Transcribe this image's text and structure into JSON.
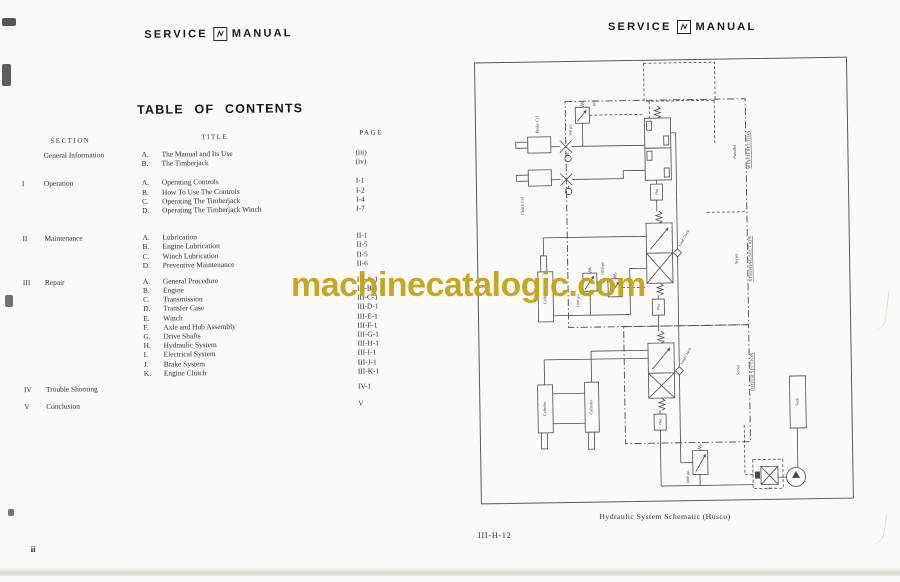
{
  "header": {
    "service": "SERVICE",
    "manual": "MANUAL"
  },
  "watermark": {
    "text": "machinecatalogic.com",
    "color": "#c2a016"
  },
  "left_page": {
    "title": "TABLE OF CONTENTS",
    "columns": {
      "section": "SECTION",
      "title": "TITLE",
      "page": "PAGE"
    },
    "groups": [
      {
        "numeral": "",
        "name": "General Information",
        "items": [
          {
            "letter": "A.",
            "title": "The Manual and Its Use",
            "page": "(iii)"
          },
          {
            "letter": "B.",
            "title": "The Timberjack",
            "page": "(iv)"
          }
        ]
      },
      {
        "numeral": "I",
        "name": "Operation",
        "items": [
          {
            "letter": "A.",
            "title": "Operating Controls",
            "page": "I-1"
          },
          {
            "letter": "B.",
            "title": "How To Use The Controls",
            "page": "I-2"
          },
          {
            "letter": "C.",
            "title": "Operating The Timberjack",
            "page": "I-4"
          },
          {
            "letter": "D.",
            "title": "Operating The Timberjack Winch",
            "page": "I-7"
          }
        ]
      },
      {
        "numeral": "II",
        "name": "Maintenance",
        "items": [
          {
            "letter": "A.",
            "title": "Lubrication",
            "page": "II-1"
          },
          {
            "letter": "B.",
            "title": "Engine Lubrication",
            "page": "II-5"
          },
          {
            "letter": "C.",
            "title": "Winch Lubrication",
            "page": "II-5"
          },
          {
            "letter": "D.",
            "title": "Preventive Maintenance",
            "page": "II-6"
          }
        ]
      },
      {
        "numeral": "III",
        "name": "Repair",
        "items": [
          {
            "letter": "A.",
            "title": "General Procedure",
            "page": "III-A-1"
          },
          {
            "letter": "B.",
            "title": "Engine",
            "page": "III-B-1"
          },
          {
            "letter": "C.",
            "title": "Transmission",
            "page": "III-C-1"
          },
          {
            "letter": "D.",
            "title": "Transfer Case",
            "page": "III-D-1"
          },
          {
            "letter": "E.",
            "title": "Winch",
            "page": "III-E-1"
          },
          {
            "letter": "F.",
            "title": "Axle and Hub Assembly",
            "page": "III-F-1"
          },
          {
            "letter": "G.",
            "title": "Drive Shafts",
            "page": "III-G-1"
          },
          {
            "letter": "H.",
            "title": "Hydraulic System",
            "page": "III-H-1"
          },
          {
            "letter": "I.",
            "title": "Electrical System",
            "page": "III-I-1"
          },
          {
            "letter": "J.",
            "title": "Brake System",
            "page": "III-J-1"
          },
          {
            "letter": "K.",
            "title": "Engine Clutch",
            "page": "III-K-1"
          }
        ]
      },
      {
        "numeral": "IV",
        "name": "Trouble Shooting",
        "items": [
          {
            "letter": "",
            "title": "",
            "page": "IV-1"
          }
        ]
      },
      {
        "numeral": "V",
        "name": "Conclusion",
        "items": [
          {
            "letter": "",
            "title": "",
            "page": "V"
          }
        ]
      }
    ],
    "page_number": "ii"
  },
  "right_page": {
    "caption": "Hydraulic System Schematic (Husco)",
    "page_ref": "III-H-12",
    "schematic": {
      "sections": [
        {
          "mode": "Parallel",
          "name": "WINCH SECTION"
        },
        {
          "mode": "Series",
          "name": "STEERING SECTION"
        },
        {
          "mode": "Series",
          "name": "DOZER SECTION"
        }
      ],
      "labels": {
        "brake_cyl": "Brake Cyl",
        "clutch_cyl": "Clutch Cyl",
        "cylinder": "Cylinder",
        "tank": "Tank",
        "load_check": "Load Check",
        "plug": "Plug",
        "relief_500": "500 psi",
        "ref": "REF",
        "relief_1500": "1500 psi",
        "relief_1850": "1850 psi",
        "relief_1800": "1800 psi",
        "filter_code": "343"
      }
    }
  }
}
